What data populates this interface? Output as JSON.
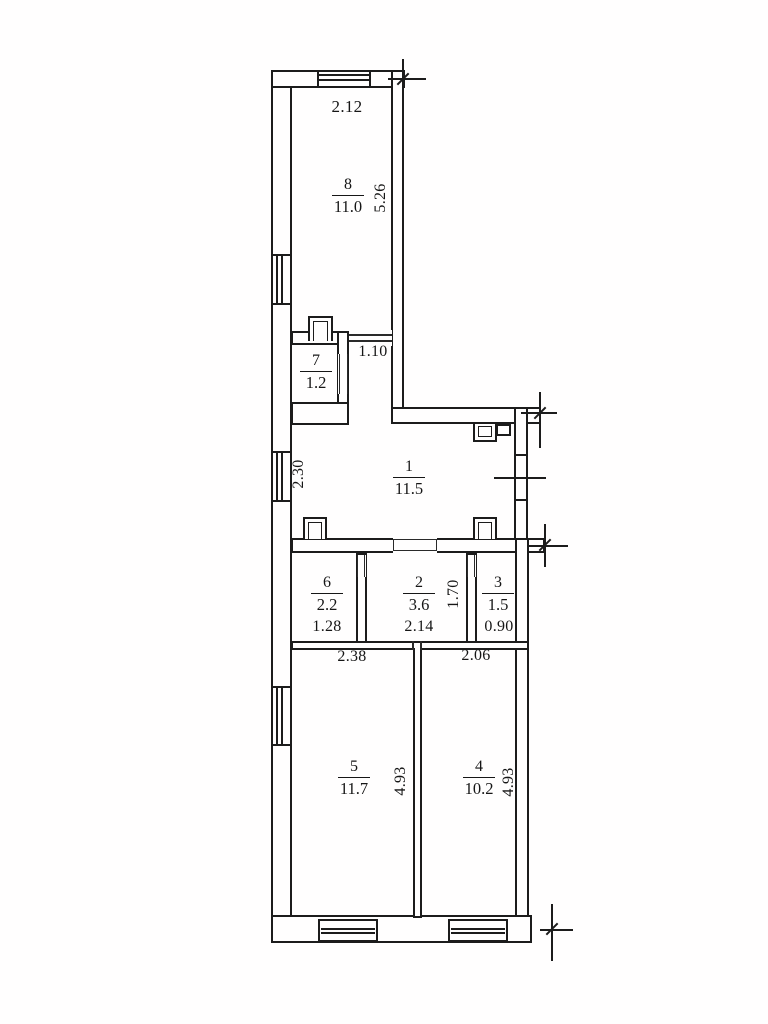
{
  "plan": {
    "title": "apartment-floor-plan-scan",
    "colors": {
      "line": "#1c1c1c",
      "background": "#fffefe"
    },
    "rooms": [
      {
        "number": "8",
        "area": "11.0"
      },
      {
        "number": "7",
        "area": "1.2"
      },
      {
        "number": "1",
        "area": "11.5"
      },
      {
        "number": "6",
        "area": "2.2"
      },
      {
        "number": "2",
        "area": "3.6"
      },
      {
        "number": "3",
        "area": "1.5"
      },
      {
        "number": "5",
        "area": "11.7"
      },
      {
        "number": "4",
        "area": "10.2"
      }
    ],
    "dims": {
      "top_width": "2.12",
      "room8_depth": "5.26",
      "hall_width": "1.10",
      "room1_wall": "2.30",
      "room6_width": "1.28",
      "room2_width": "2.14",
      "room2_depth": "1.70",
      "room3_width": "0.90",
      "room5_top": "2.38",
      "room4_top": "2.06",
      "room5_depth": "4.93",
      "room4_depth": "4.93"
    }
  }
}
